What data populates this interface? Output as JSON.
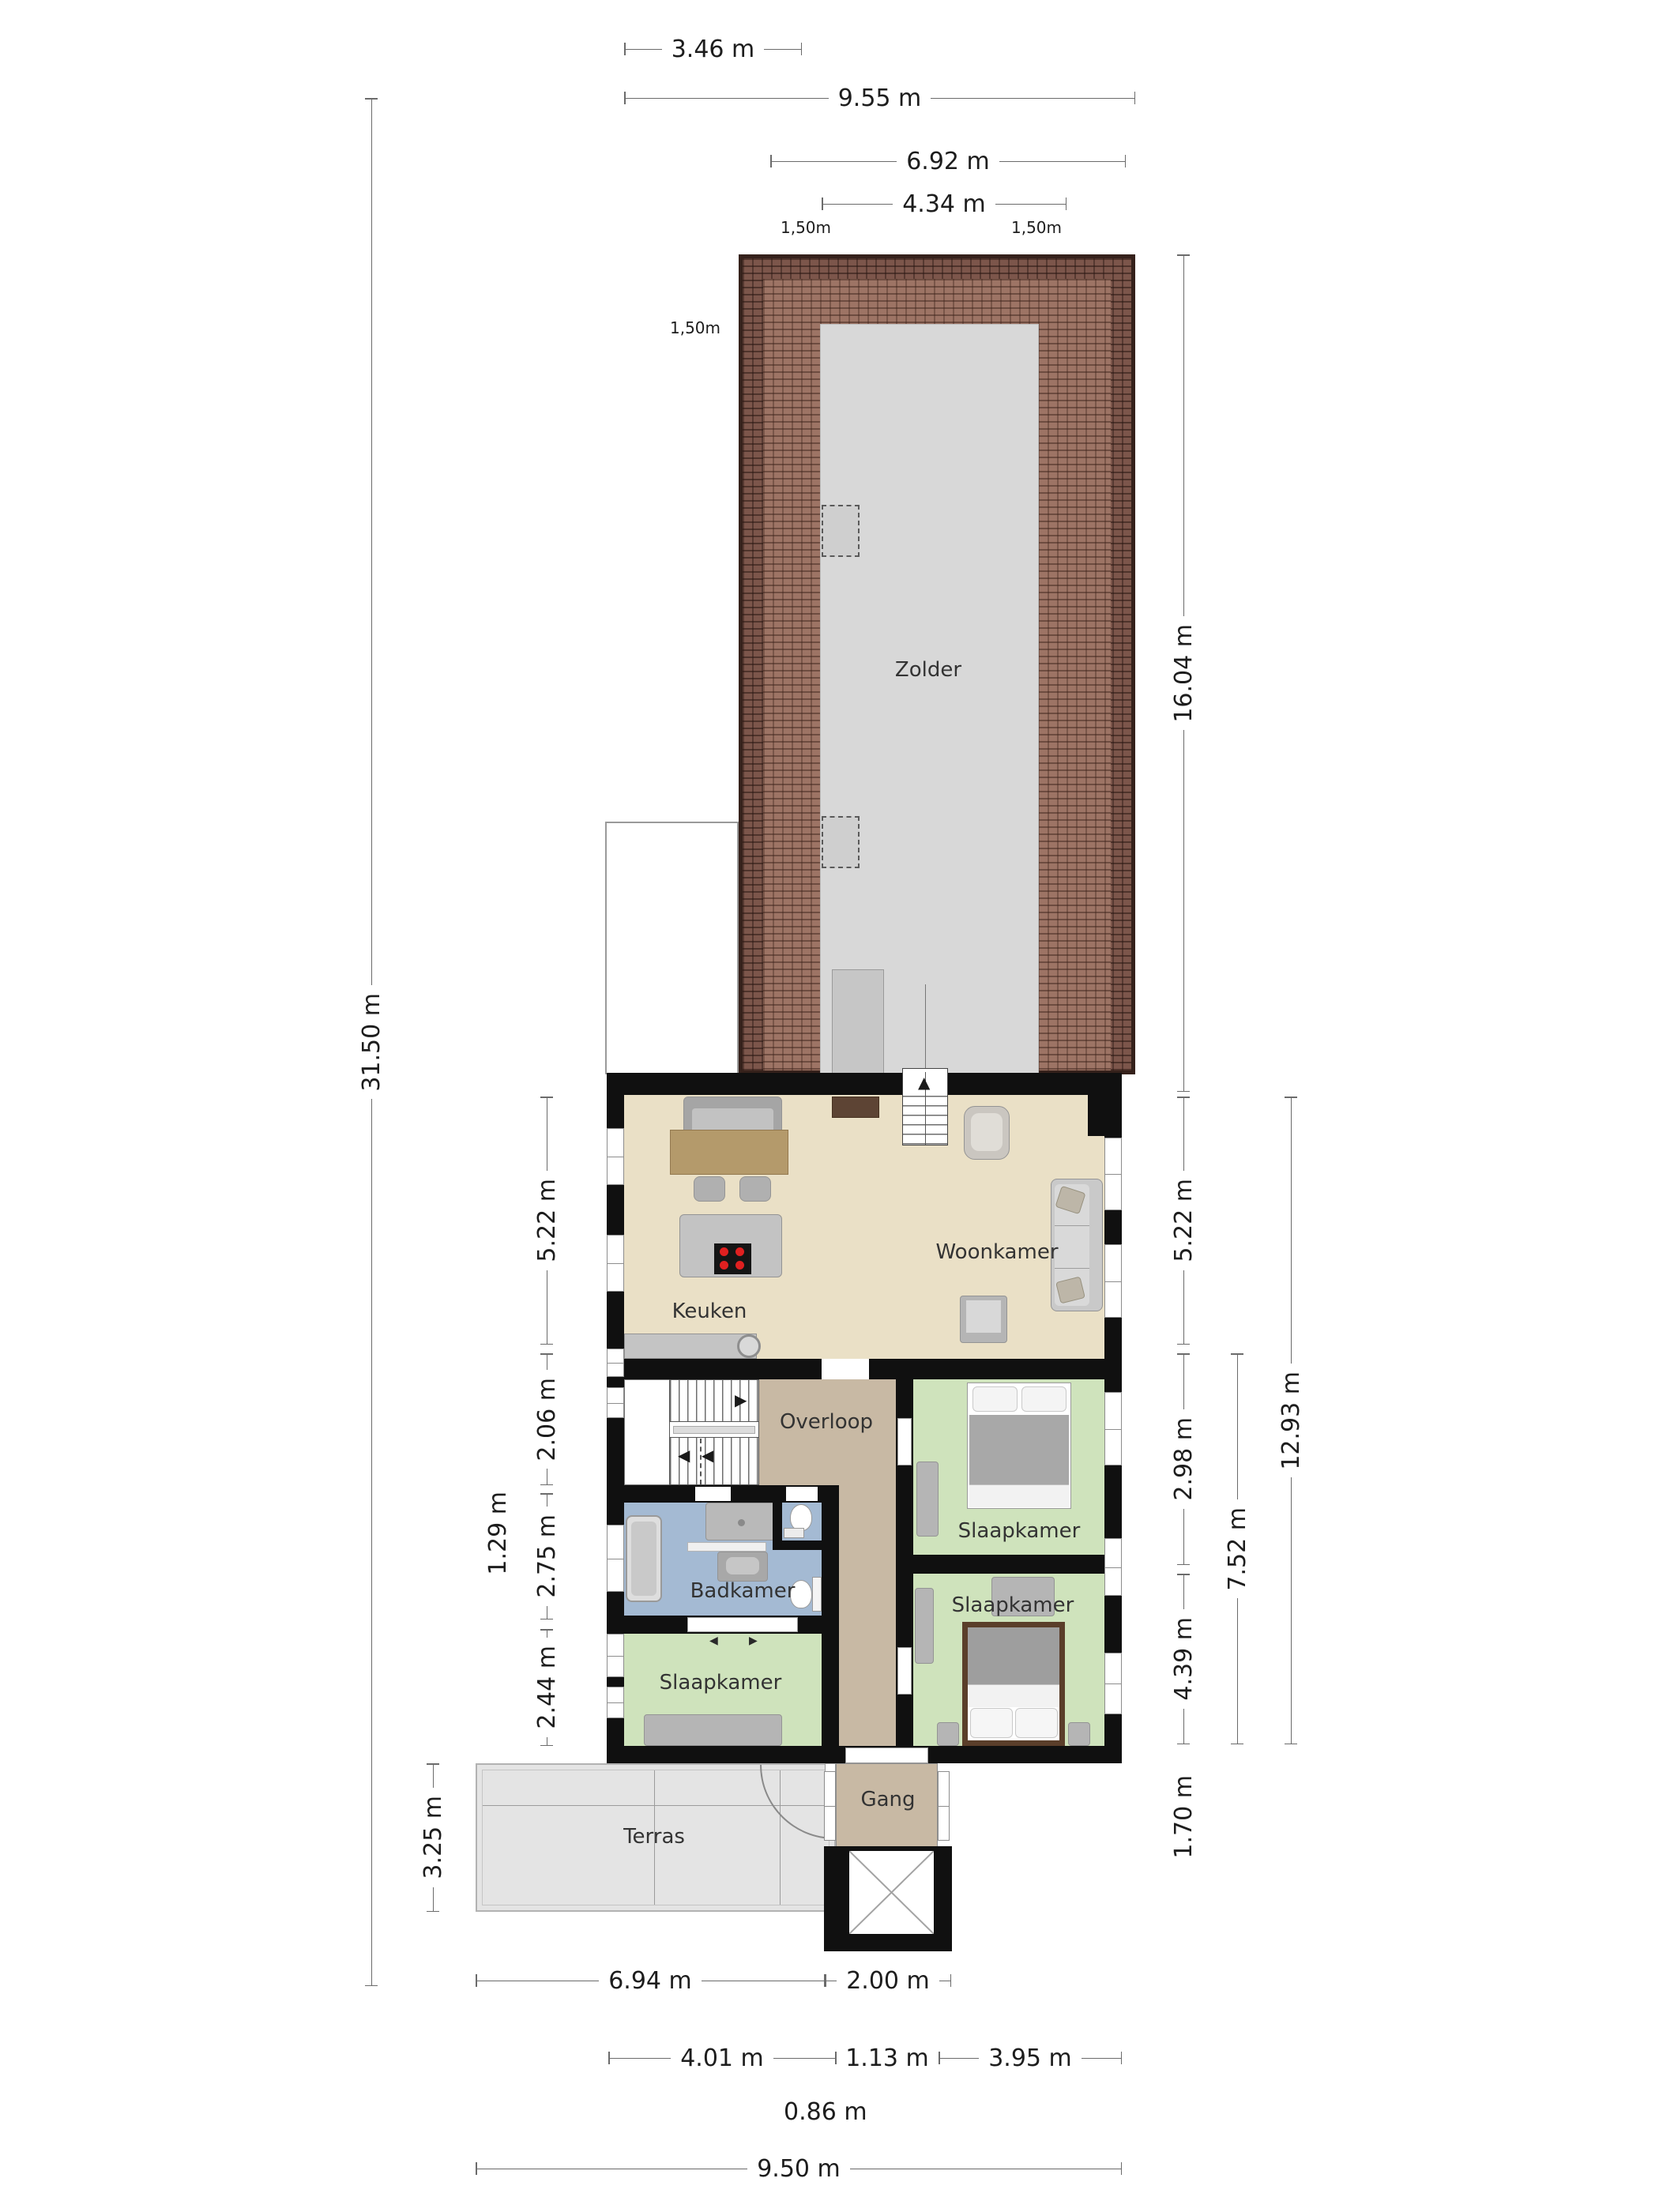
{
  "title": "Eerste verdieping plattegrond",
  "colors": {
    "wall": "#101010",
    "living_floor": "#eae0c6",
    "bedroom_floor": "#cfe3bc",
    "bathroom_floor": "#a4bad3",
    "hall_floor": "#c8b9a4",
    "attic_floor": "#d8d8d8",
    "terrace_floor": "#e4e4e4",
    "roof_tile": "#9d7465",
    "roof_tile_dark": "#7c564b",
    "cooktop_burner": "#e02020",
    "wood_table": "#b49a6b",
    "dark_wood": "#5d4434"
  },
  "rooms": {
    "zolder": {
      "label": "Zolder"
    },
    "woonkamer": {
      "label": "Woonkamer"
    },
    "keuken": {
      "label": "Keuken"
    },
    "overloop": {
      "label": "Overloop"
    },
    "slaapkamer_boven": {
      "label": "Slaapkamer"
    },
    "slaapkamer_onder": {
      "label": "Slaapkamer"
    },
    "slaapkamer_links": {
      "label": "Slaapkamer"
    },
    "badkamer": {
      "label": "Badkamer"
    },
    "gang": {
      "label": "Gang"
    },
    "terras": {
      "label": "Terras"
    }
  },
  "dimensions": {
    "top": [
      {
        "label": "3.46 m"
      },
      {
        "label": "9.55 m"
      },
      {
        "label": "6.92 m"
      },
      {
        "label": "4.34 m"
      }
    ],
    "roof_annotations": [
      {
        "label": "1,50m"
      },
      {
        "label": "1,50m"
      },
      {
        "label": "1,50m"
      }
    ],
    "left": [
      {
        "label": "31.50 m"
      },
      {
        "label": "5.22 m"
      },
      {
        "label": "2.06 m"
      },
      {
        "label": "1.29 m"
      },
      {
        "label": "2.75 m"
      },
      {
        "label": "2.44 m"
      },
      {
        "label": "3.25 m"
      }
    ],
    "right": [
      {
        "label": "16.04 m"
      },
      {
        "label": "5.22 m"
      },
      {
        "label": "2.98 m"
      },
      {
        "label": "12.93 m"
      },
      {
        "label": "7.52 m"
      },
      {
        "label": "4.39 m"
      },
      {
        "label": "1.70 m"
      }
    ],
    "bottom": [
      {
        "label": "6.94 m"
      },
      {
        "label": "2.00 m"
      },
      {
        "label": "4.01 m"
      },
      {
        "label": "1.13 m"
      },
      {
        "label": "3.95 m"
      },
      {
        "label": "0.86 m"
      },
      {
        "label": "9.50 m"
      }
    ]
  }
}
